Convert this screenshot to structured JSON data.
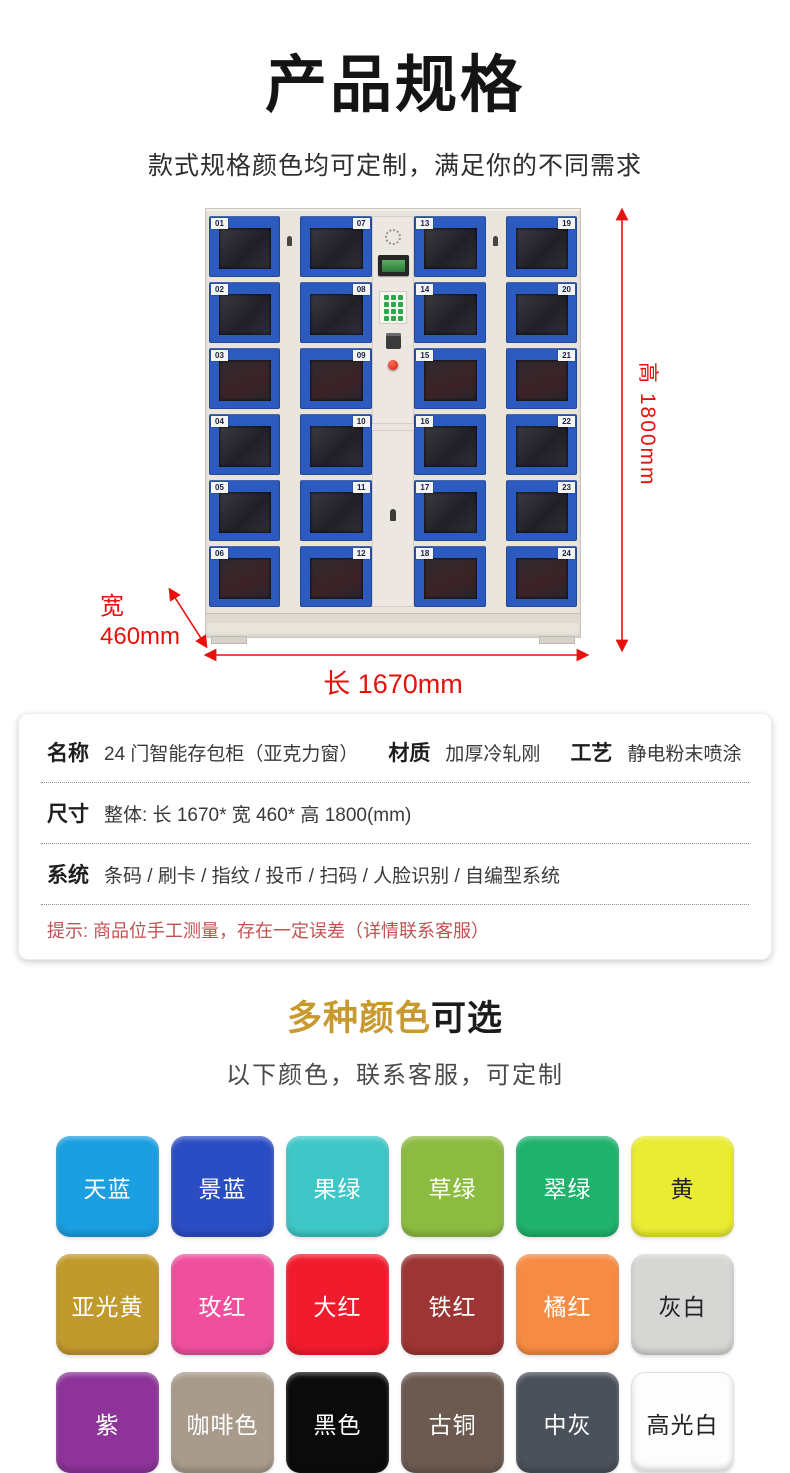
{
  "page": {
    "title": "产品规格",
    "subtitle": "款式规格颜色均可定制，满足你的不同需求"
  },
  "locker": {
    "columns": [
      {
        "tag_side": "left",
        "doors": [
          "01",
          "02",
          "03",
          "04",
          "05",
          "06"
        ]
      },
      {
        "tag_side": "right",
        "doors": [
          "07",
          "08",
          "09",
          "10",
          "11",
          "12"
        ]
      },
      {
        "tag_side": "left",
        "doors": [
          "13",
          "14",
          "15",
          "16",
          "17",
          "18"
        ]
      },
      {
        "tag_side": "right",
        "doors": [
          "19",
          "20",
          "21",
          "22",
          "23",
          "24"
        ]
      }
    ],
    "dimensions": {
      "height_label": "高 1800mm",
      "width_label": "宽",
      "width_value": "460mm",
      "length_label": "长 1670mm",
      "arrow_color": "#e8100c"
    }
  },
  "specs": {
    "rows": [
      {
        "pairs": [
          {
            "label": "名称",
            "value": "24 门智能存包柜（亚克力窗）"
          },
          {
            "label": "材质",
            "value": "加厚冷轧刚"
          },
          {
            "label": "工艺",
            "value": "静电粉末喷涂"
          }
        ]
      },
      {
        "pairs": [
          {
            "label": "尺寸",
            "value": "整体: 长 1670* 宽 460* 高 1800(mm)"
          }
        ]
      },
      {
        "pairs": [
          {
            "label": "系统",
            "value": "条码 / 刷卡 / 指纹 / 投币 / 扫码 / 人脸识别 / 自编型系统"
          }
        ]
      }
    ],
    "note": "提示: 商品位手工测量，存在一定误差（详情联系客服）"
  },
  "colors_section": {
    "heading_highlight": "多种颜色",
    "heading_rest": "可选",
    "heading_highlight_color": "#c7992f",
    "subheading": "以下颜色，联系客服，可定制",
    "swatches": [
      {
        "name": "天蓝",
        "hex": "#1a9fe0",
        "text": "#ffffff"
      },
      {
        "name": "景蓝",
        "hex": "#2b4dc3",
        "text": "#ffffff"
      },
      {
        "name": "果绿",
        "hex": "#3fc7c7",
        "text": "#ffffff"
      },
      {
        "name": "草绿",
        "hex": "#8cbb41",
        "text": "#ffffff"
      },
      {
        "name": "翠绿",
        "hex": "#1fb26d",
        "text": "#ffffff"
      },
      {
        "name": "黄",
        "hex": "#e9ec33",
        "text": "#222222"
      },
      {
        "name": "亚光黄",
        "hex": "#c19a2d",
        "text": "#ffffff"
      },
      {
        "name": "玫红",
        "hex": "#ef4f9d",
        "text": "#ffffff"
      },
      {
        "name": "大红",
        "hex": "#f01c2d",
        "text": "#ffffff"
      },
      {
        "name": "铁红",
        "hex": "#9c3534",
        "text": "#ffffff"
      },
      {
        "name": "橘红",
        "hex": "#f68b43",
        "text": "#ffffff"
      },
      {
        "name": "灰白",
        "hex": "#d6d6d4",
        "text": "#222222"
      },
      {
        "name": "紫",
        "hex": "#8d3399",
        "text": "#ffffff"
      },
      {
        "name": "咖啡色",
        "hex": "#a89b8c",
        "text": "#ffffff"
      },
      {
        "name": "黑色",
        "hex": "#0b0b0b",
        "text": "#ffffff"
      },
      {
        "name": "古铜",
        "hex": "#6c5a51",
        "text": "#ffffff"
      },
      {
        "name": "中灰",
        "hex": "#4b515b",
        "text": "#ffffff"
      },
      {
        "name": "高光白",
        "hex": "#fdfdfd",
        "text": "#222222"
      }
    ]
  }
}
